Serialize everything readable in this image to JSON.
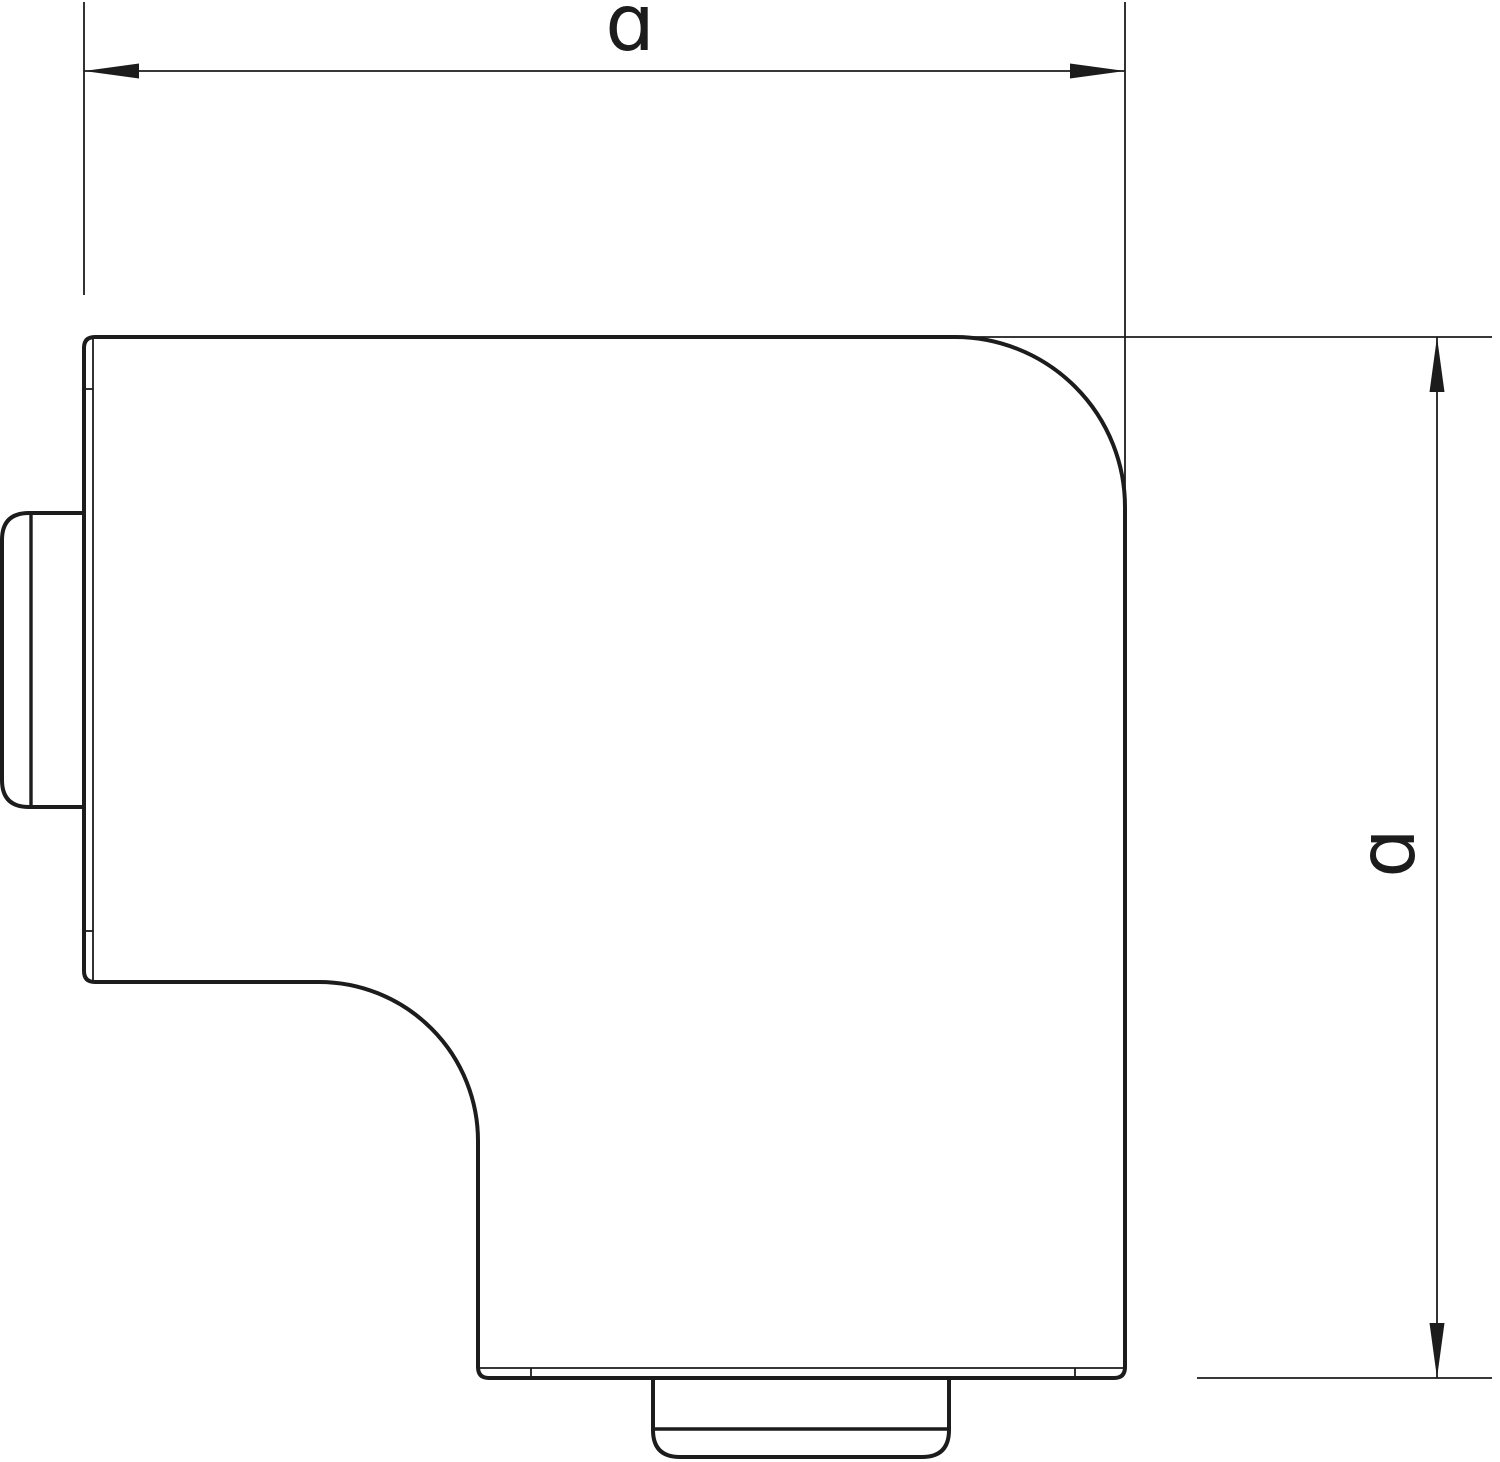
{
  "page": {
    "background": "#ffffff"
  },
  "colors": {
    "line": "#1c1c1c",
    "fill": "#ffffff"
  },
  "dimensions": {
    "width": {
      "label": "a",
      "glyph": "ɑ"
    },
    "height": {
      "label": "a",
      "glyph": "ɑ"
    }
  }
}
